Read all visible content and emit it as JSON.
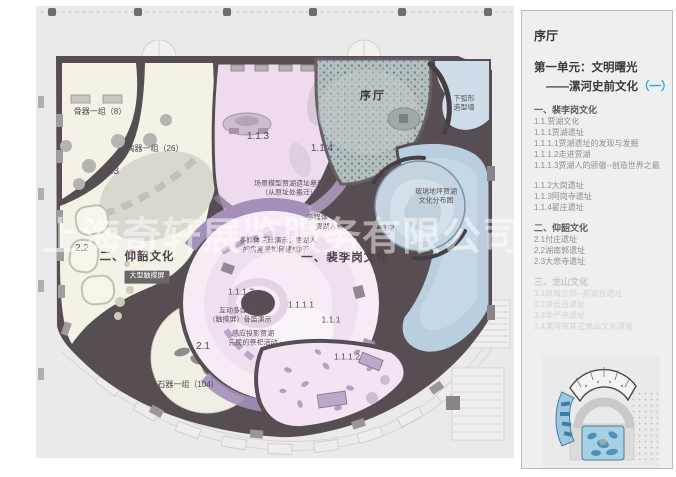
{
  "watermark": "上海奇轩展览服务有限公司",
  "sidebar": {
    "hall_label": "序厅",
    "unit_line1": "第一单元：文明曙光",
    "unit_line2_dash": "——漯河史前文化",
    "unit_line2_paren": "（一）",
    "accent_color": "#29abe2",
    "floor_label": "2F",
    "outline": {
      "group1_title": "一、裴李岗文化",
      "group1": [
        "1.1.贾湖文化",
        "1.1.1贾湖遗址",
        "1.1.1.1贾湖遗址的发现与发掘",
        "1.1.1.2走进贾湖",
        "1.1.1.3贾湖人的骄傲--创造世界之最"
      ],
      "group1b": [
        "1.1.2大岗遗址",
        "1.1.3阿岗寺遗址",
        "1.1.4翟庄遗址"
      ],
      "group2_title": "二、仰韶文化",
      "group2": [
        "2.1付庄遗址",
        "2.2湖南郭遗址",
        "2.3大悲寺遗址"
      ],
      "group3_title": "三、龙山文化",
      "group3": [
        "3.1筑城立邦--郝家台遗址",
        "3.2凌云台遗址",
        "3.3华严寺遗址",
        "3.4漯河市其它龙山文化遗址"
      ]
    }
  },
  "plan": {
    "labels": {
      "bone_group": "骨器一组（8）",
      "pottery_group": "陶器一组（26）",
      "zone_2_3": "2.3",
      "zone_2_2": "2.2",
      "yangshao_title": "二、仰韶文化",
      "touch_screen": "大型触摸屏",
      "zone_2_1": "2.1",
      "stone_group": "石器一组（104）",
      "zone_1_1_3": "1.1.3",
      "zone_1_1_4": "1.1.4",
      "scene_model": "场景模型贾湖遗址墓葬\n（从原址处搬迁）",
      "media_anim": "多媒体（动画演示）：\n贾湖人制陶过程",
      "zone_1_1_2": "1.1.2",
      "media_3d": "多媒体三维演示：贾湖人\n的房屋是如何建成的？",
      "peiligang_title": "一、裴李岗文化",
      "zone_1_1_1_3": "1.1.1.3",
      "media_touch": "互动多媒体：\n（触摸屏）骨笛演示",
      "zone_1_1_1_1": "1.1.1.1",
      "zone_1_1_1": "1.1.1",
      "media_projection": "感应投影贾湖\n先民的祭祀活动",
      "zone_1_1_1_2": "1.1.1.2",
      "zone_1_1": "1.1",
      "hall_lobby": "序厅",
      "curved_wall": "下弧形\n造型墙",
      "ground_line": "地面线",
      "glass_floor": "玻璃地坪贾湖\n文化分布图"
    }
  }
}
